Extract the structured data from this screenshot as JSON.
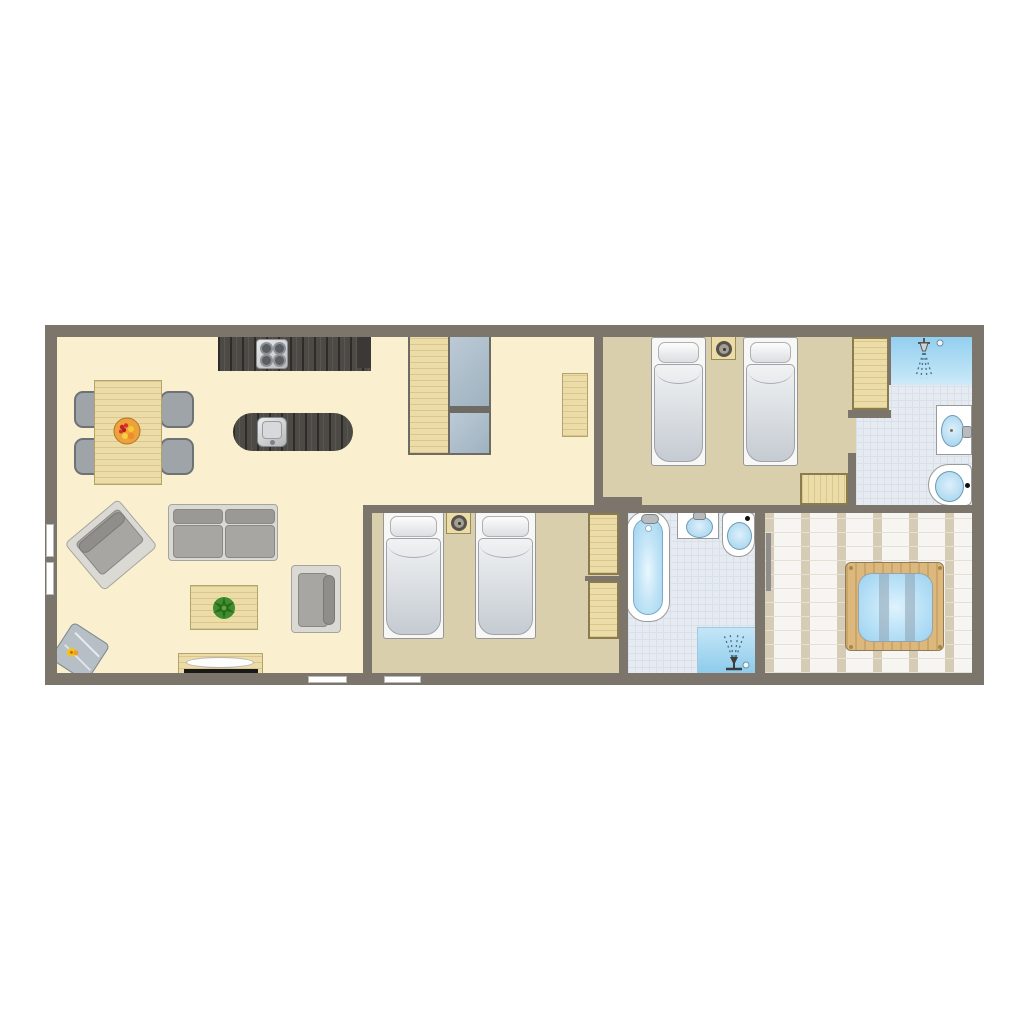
{
  "image_type": "holiday-lodge-floor-plan",
  "orientation": "top-down 2D plan on white background, no text labels",
  "palette": {
    "wall": "#7b756c",
    "floor_living": "#faf0d0",
    "floor_bedroom": "#d9cfac",
    "floor_tile": "#e6ebf1",
    "shower_blue": "#93cfef",
    "wood_dark": "#4d4a46",
    "wood_light": "#ecdda8",
    "furniture_gray": "#a8a6a2",
    "water_blue": "#a9d9f2",
    "deck_plank": "#d6cbb5",
    "hot_tub_wood": "#dcb87c"
  },
  "rooms": [
    {
      "id": "living-kitchen",
      "floor": "cream",
      "furniture": [
        "dining-table",
        "dining-chair",
        "dining-chair",
        "dining-chair",
        "dining-chair",
        "fruit-bowl",
        "kitchen-counter",
        "cooktop",
        "kitchen-island",
        "island-sink",
        "sofa",
        "armchair-rotated",
        "armchair",
        "coffee-table",
        "plant",
        "side-table",
        "tv-cabinet",
        "tv"
      ]
    },
    {
      "id": "hallway",
      "floor": "cream",
      "furniture": [
        "closet-wood-mirror",
        "wall-cabinet"
      ]
    },
    {
      "id": "bedroom-1",
      "floor": "tan",
      "furniture": [
        "single-bed",
        "single-bed",
        "nightstand",
        "table-lamp",
        "wardrobe",
        "low-cabinet"
      ]
    },
    {
      "id": "ensuite-bathroom",
      "floor": "tile",
      "furniture": [
        "walk-in-shower",
        "shower-head",
        "washbasin",
        "toilet"
      ]
    },
    {
      "id": "bedroom-2",
      "floor": "tan",
      "furniture": [
        "single-bed",
        "single-bed",
        "nightstand",
        "table-lamp",
        "wardrobe",
        "wardrobe"
      ]
    },
    {
      "id": "family-bathroom",
      "floor": "tile",
      "furniture": [
        "bathtub",
        "washbasin",
        "toilet",
        "shower-corner",
        "shower-sprayer"
      ]
    },
    {
      "id": "terrace",
      "floor": "deck",
      "furniture": [
        "hot-tub-with-cover-bars",
        "deck-rail"
      ]
    }
  ],
  "openings": {
    "left_wall_windows": 2,
    "bottom_wall_windows": 2,
    "ensuite_door_gap": "between bedroom-1 and ensuite-bathroom"
  },
  "counts": {
    "bedrooms": 2,
    "bathrooms": 2,
    "single_beds": 4,
    "showers": 2,
    "bathtubs": 1,
    "toilets": 2,
    "washbasins": 2
  }
}
